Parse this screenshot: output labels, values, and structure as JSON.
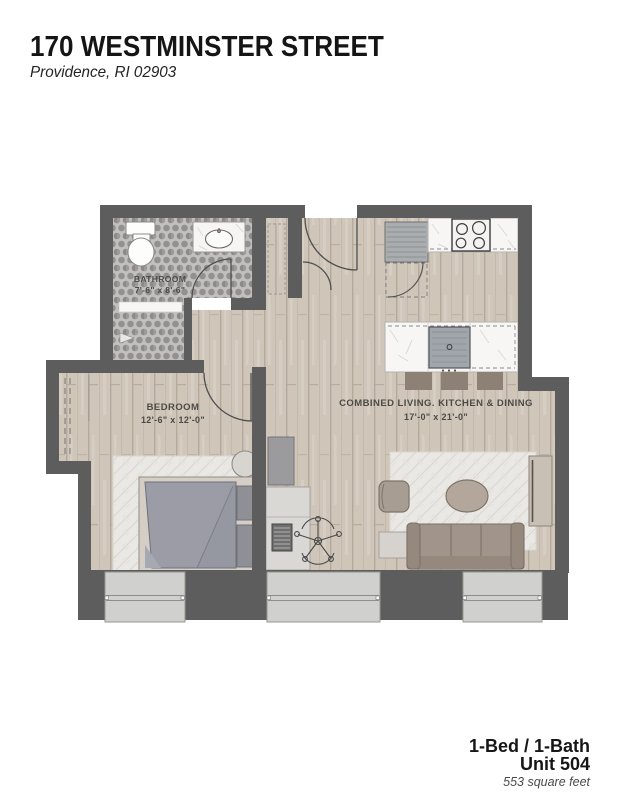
{
  "header": {
    "title": "170 WESTMINSTER STREET",
    "subtitle": "Providence, RI 02903"
  },
  "floorplan": {
    "rooms": [
      {
        "name": "BATHROOM",
        "dims": "7'-6\" x 8'-6\""
      },
      {
        "name": "BEDROOM",
        "dims": "12'-6\" x 12'-0\""
      },
      {
        "name": "COMBINED LIVING. KITCHEN & DINING",
        "dims": "17'-0\" x 21'-0\""
      }
    ],
    "fixtures": [
      "toilet",
      "vanity-sink",
      "shower-closet",
      "entry-door",
      "closet-door",
      "refrigerator",
      "cooktop",
      "kitchen-counter",
      "kitchen-island",
      "island-sink",
      "bar-stools",
      "sofa",
      "armchair",
      "coffee-table",
      "side-table",
      "tv-console",
      "area-rugs",
      "bed",
      "pillows",
      "bedside-table",
      "closet-rod",
      "wardrobe",
      "desk",
      "laptop",
      "office-chair",
      "windows"
    ],
    "colors": {
      "wall": "#5e5d5d",
      "wood_floor": "#cfc5b9",
      "tile_floor": "#a8a6a3",
      "rug": "#eae8e4",
      "counter": "#f7f6f4",
      "furniture_taupe": "#a1948a",
      "duvet_gray": "#9698a2",
      "window": "#d0d0ce"
    }
  },
  "footer": {
    "unit_type": "1-Bed / 1-Bath",
    "unit_number": "Unit 504",
    "area": "553 square feet"
  }
}
